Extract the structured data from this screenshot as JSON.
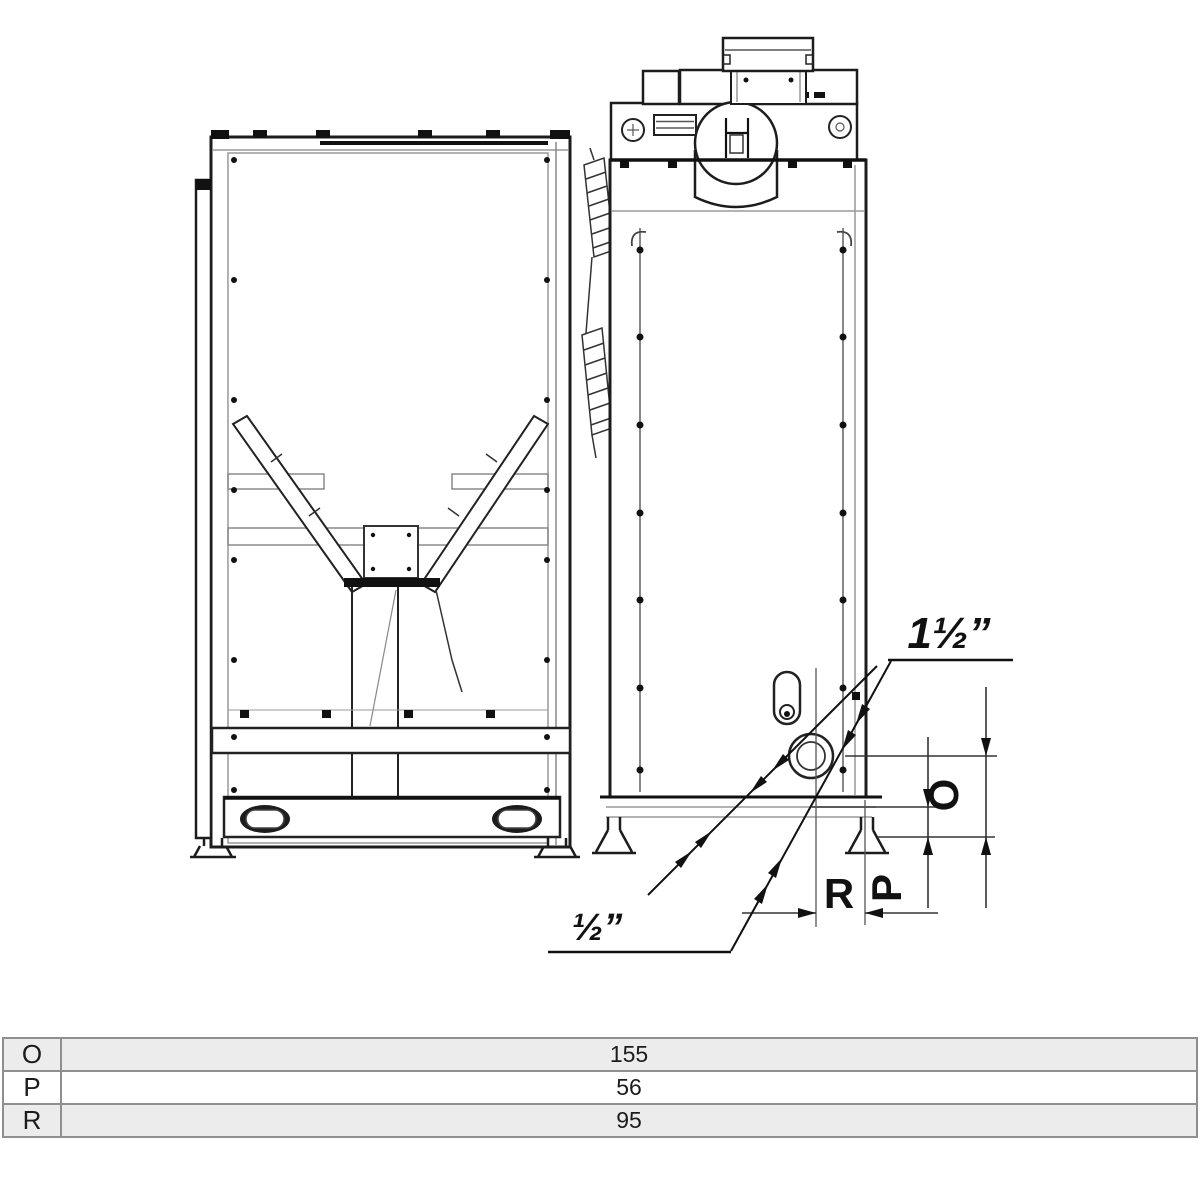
{
  "page": {
    "background": "#ffffff",
    "line_color": "#1c1c1c"
  },
  "drawing": {
    "labels": {
      "connection_top": "1½”",
      "connection_bottom": "½”",
      "dim_o": "O",
      "dim_p": "P",
      "dim_r": "R"
    }
  },
  "table": {
    "rows": [
      {
        "key": "O",
        "value": "155"
      },
      {
        "key": "P",
        "value": "56"
      },
      {
        "key": "R",
        "value": "95"
      }
    ]
  }
}
